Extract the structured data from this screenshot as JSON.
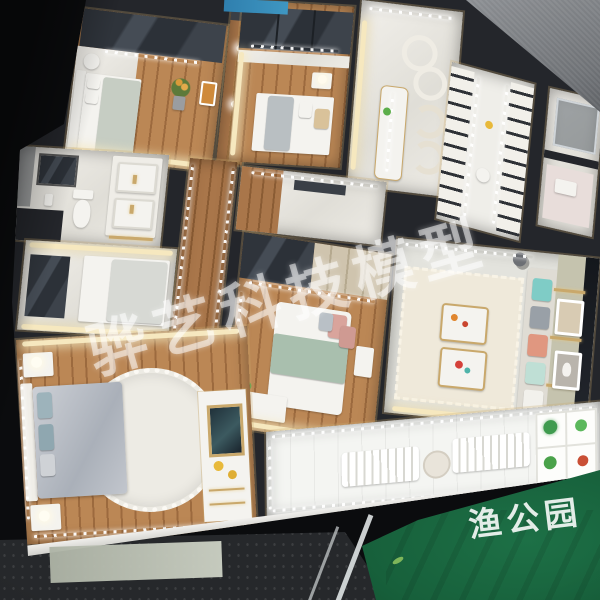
{
  "photo": {
    "subject": "top-down photo of a miniature apartment scale model with LED-lit rooms",
    "watermark_text": "骅艺科技模型",
    "park_label": "渔公园"
  },
  "colors": {
    "background": "#0b0c0e",
    "walls": "#24262b",
    "wood_floor": "#bb8755",
    "marble_floor": "#eceae4",
    "led_warm": "#f6e8bf",
    "led_cool": "#ffffff",
    "gold_trim": "#c9a86b",
    "green_fabric": "#17603b",
    "gray_fabric": "#83868b",
    "asphalt_ground": "#26282b",
    "sofa_pillows": [
      "#7fccc6",
      "#99a0a7",
      "#e09780",
      "#bfdfd5",
      "#f2f1ec"
    ],
    "master_bedding": "#bfc3ca",
    "blue_reflection": "#2f7fae"
  }
}
